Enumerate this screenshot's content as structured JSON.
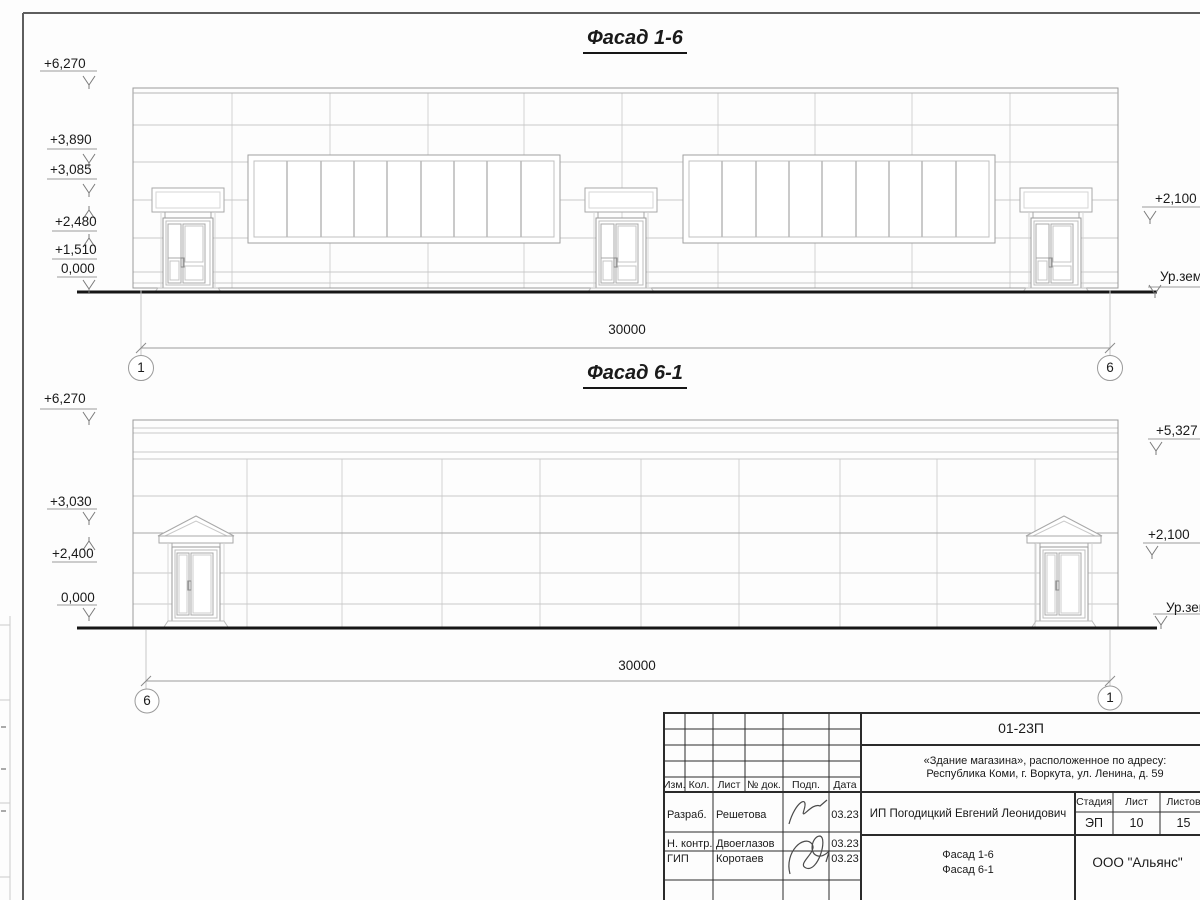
{
  "sheet": {
    "facade1": {
      "title": "Фасад 1-6",
      "marks_left": [
        {
          "label": "+6,270"
        },
        {
          "label": "+3,890"
        },
        {
          "label": "+3,085"
        },
        {
          "label": "+2,480"
        },
        {
          "label": "+1,510"
        },
        {
          "label": "0,000"
        }
      ],
      "marks_right": [
        {
          "label": "+2,100"
        },
        {
          "label": "Ур.зем"
        }
      ],
      "dimension": "30000",
      "axis_left": "1",
      "axis_right": "6"
    },
    "facade2": {
      "title": "Фасад 6-1",
      "marks_left": [
        {
          "label": "+6,270"
        },
        {
          "label": "+3,030"
        },
        {
          "label": "+2,400"
        },
        {
          "label": "0,000"
        }
      ],
      "marks_right": [
        {
          "label": "+5,327"
        },
        {
          "label": "+2,100"
        },
        {
          "label": "Ур.зем"
        }
      ],
      "dimension": "30000",
      "axis_left": "6",
      "axis_right": "1"
    },
    "titleblock": {
      "doc_number": "01-23П",
      "project_line1": "«Здание магазина», расположенное по адресу:",
      "project_line2": "Республика Коми, г. Воркута, ул. Ленина, д. 59",
      "header_cols": [
        "Изм.",
        "Кол.",
        "Лист",
        "№ док.",
        "Подп.",
        "Дата"
      ],
      "rows": [
        {
          "role": "Разраб.",
          "name": "Решетова",
          "date": "03.23"
        },
        {
          "role": "Н. контр.",
          "name": "Двоеглазов",
          "date": "03.23"
        },
        {
          "role": "ГИП",
          "name": "Коротаев",
          "date": "03.23"
        }
      ],
      "client": "ИП Погодицкий Евгений Леонидович",
      "stage_label": "Стадия",
      "sheet_label": "Лист",
      "sheets_label": "Листов",
      "stage": "ЭП",
      "sheet_no": "10",
      "sheets_total": "15",
      "drawing_name_line1": "Фасад 1-6",
      "drawing_name_line2": "Фасад 6-1",
      "company": "ООО \"Альянс\""
    }
  }
}
